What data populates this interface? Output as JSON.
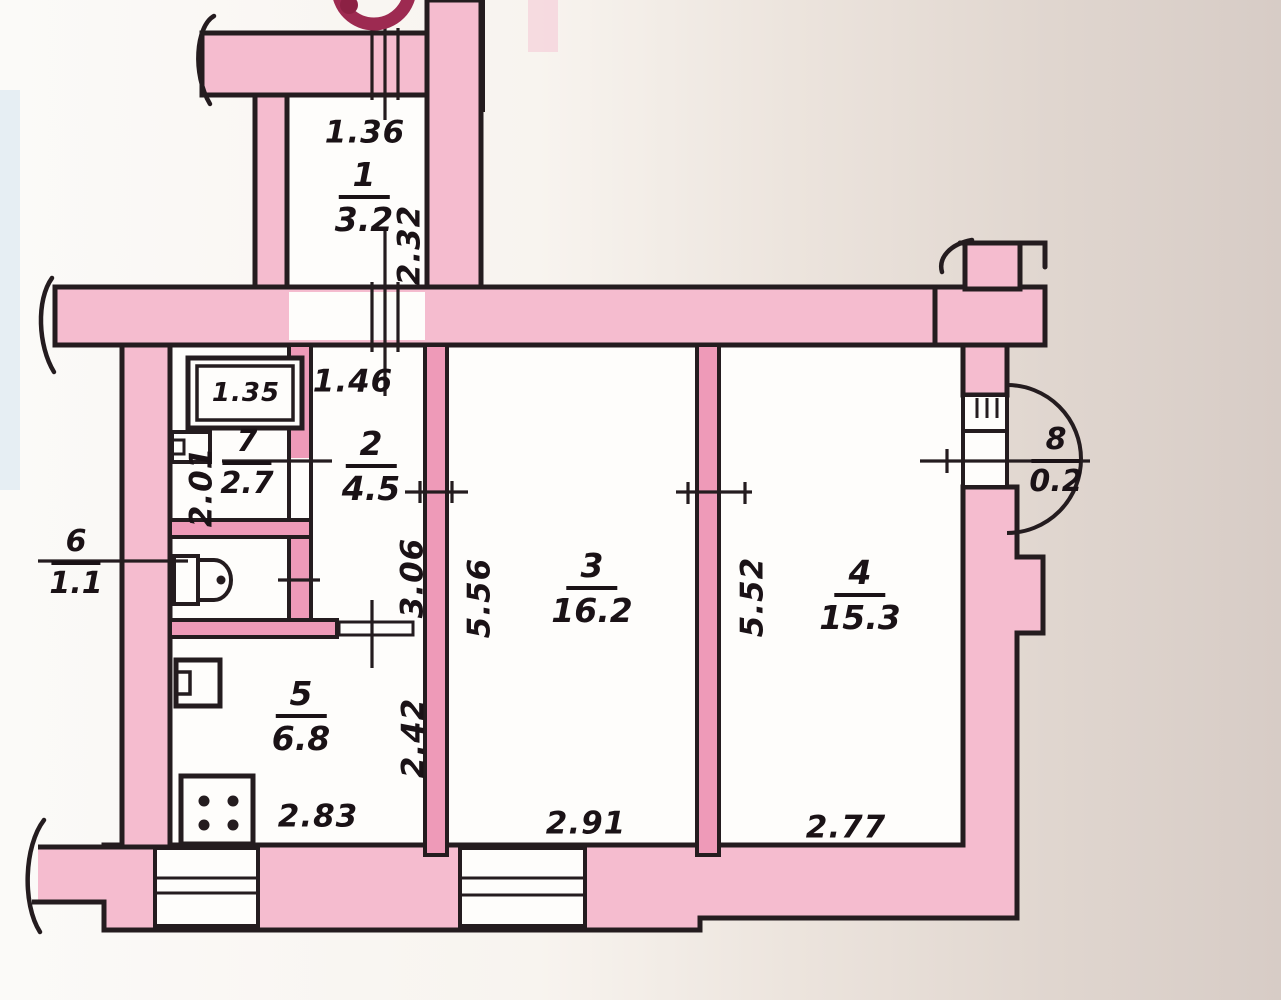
{
  "document": {
    "kind": "hand-drawn apartment floor plan (scanned)",
    "units_note": "metres / square metres"
  },
  "rooms": {
    "r1": {
      "number": "1",
      "area": "3.2"
    },
    "r2": {
      "number": "2",
      "area": "4.5"
    },
    "r3": {
      "number": "3",
      "area": "16.2"
    },
    "r4": {
      "number": "4",
      "area": "15.3"
    },
    "r5": {
      "number": "5",
      "area": "6.8"
    },
    "r6": {
      "number": "6",
      "area": "1.1"
    },
    "r7": {
      "number": "7",
      "area": "2.7"
    },
    "r8": {
      "number": "8",
      "area": "0.2"
    }
  },
  "dimensions": {
    "d136": "1.36",
    "d232": "2.32",
    "d146": "1.46",
    "d201": "2.01",
    "d306": "3.06",
    "d556": "5.56",
    "d552": "5.52",
    "d242": "2.42",
    "d283": "2.83",
    "d291": "2.91",
    "d277": "2.77",
    "bathtub": "1.35"
  },
  "fixtures": {
    "bathtub": "bathtub",
    "washbasin": "washbasin",
    "toilet": "toilet",
    "sink": "kitchen-sink",
    "stove": "stove"
  },
  "colors": {
    "wall_pink": "#f5bccf",
    "partition_pink": "#ee9ab8",
    "line": "#241c1f",
    "stamp_red": "#9d2a51",
    "paper_left": "#fbfaf8",
    "paper_right": "#d7ccc6"
  }
}
